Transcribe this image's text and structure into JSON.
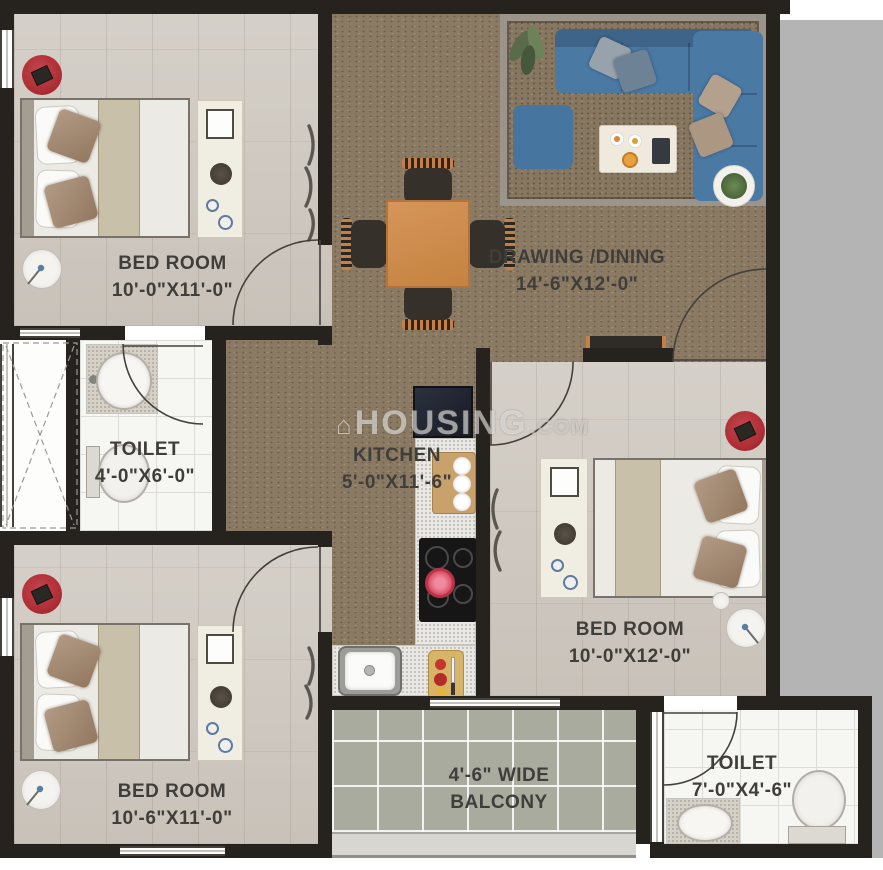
{
  "watermark": {
    "glyph": "⌂",
    "name": "HOUSING",
    "tld": ".COM"
  },
  "rooms": [
    {
      "id": "bedroom-top-left",
      "line1": "BED ROOM",
      "line2": "10'-0\"X11'-0\""
    },
    {
      "id": "drawing-dining",
      "line1": "DRAWING /DINING",
      "line2": "14'-6\"X12'-0\""
    },
    {
      "id": "toilet-left",
      "line1": "TOILET",
      "line2": "4'-0\"X6'-0\""
    },
    {
      "id": "kitchen",
      "line1": "KITCHEN",
      "line2": "5'-0\"X11'-6\""
    },
    {
      "id": "bedroom-right",
      "line1": "BED ROOM",
      "line2": "10'-0\"X12'-0\""
    },
    {
      "id": "bedroom-bottom-left",
      "line1": "BED ROOM",
      "line2": "10'-6\"X11'-0\""
    },
    {
      "id": "balcony",
      "line1": "4'-6\" WIDE",
      "line2": "BALCONY"
    },
    {
      "id": "toilet-bottom-right",
      "line1": "TOILET",
      "line2": "7'-0\"X4'-6\""
    }
  ],
  "colors": {
    "wall": "#26221d",
    "carpet": "#8b7a63",
    "wood_floor": "#cfc9c1",
    "tile": "#f6f6f3",
    "balcony_tile": "#a9ab9f",
    "sofa_blue": "#4a79a4",
    "dining_table": "#cf8d50",
    "rug_red": "#b23138",
    "label_text": "#403e3a",
    "background_right": "#b4b4b4"
  }
}
